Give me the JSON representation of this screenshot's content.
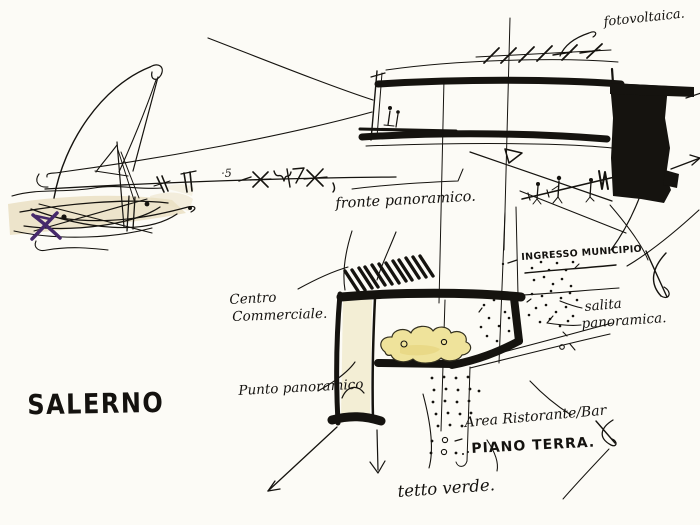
{
  "page": {
    "kind": "architectural concept sketch"
  },
  "colors": {
    "ink": "#15130f",
    "paper": "#fcfbf6",
    "wash_beige": "#e9dfc1",
    "wall_cream": "#f2ecd2",
    "wash_yellow": "#efe39b",
    "blob_shade": "#e3d176",
    "accent_purple": "#46296b"
  },
  "labels": {
    "title": "SALERNO",
    "fotovoltaica": "fotovoltaica.",
    "fronte_panoramico": "fronte panoramico.",
    "ingresso_municipio": "INGRESSO MUNICIPIO",
    "salita_line1": "salita",
    "salita_line2": "panoramica.",
    "centro_line1": "Centro",
    "centro_line2": "Commerciale.",
    "punto_panoramico": "Punto panoramico",
    "area_ristorante": "Area Ristorante/Bar",
    "piano_terra": "PIANO TERRA.",
    "tetto_verde": "tetto verde.",
    "ground_note": "·5"
  }
}
